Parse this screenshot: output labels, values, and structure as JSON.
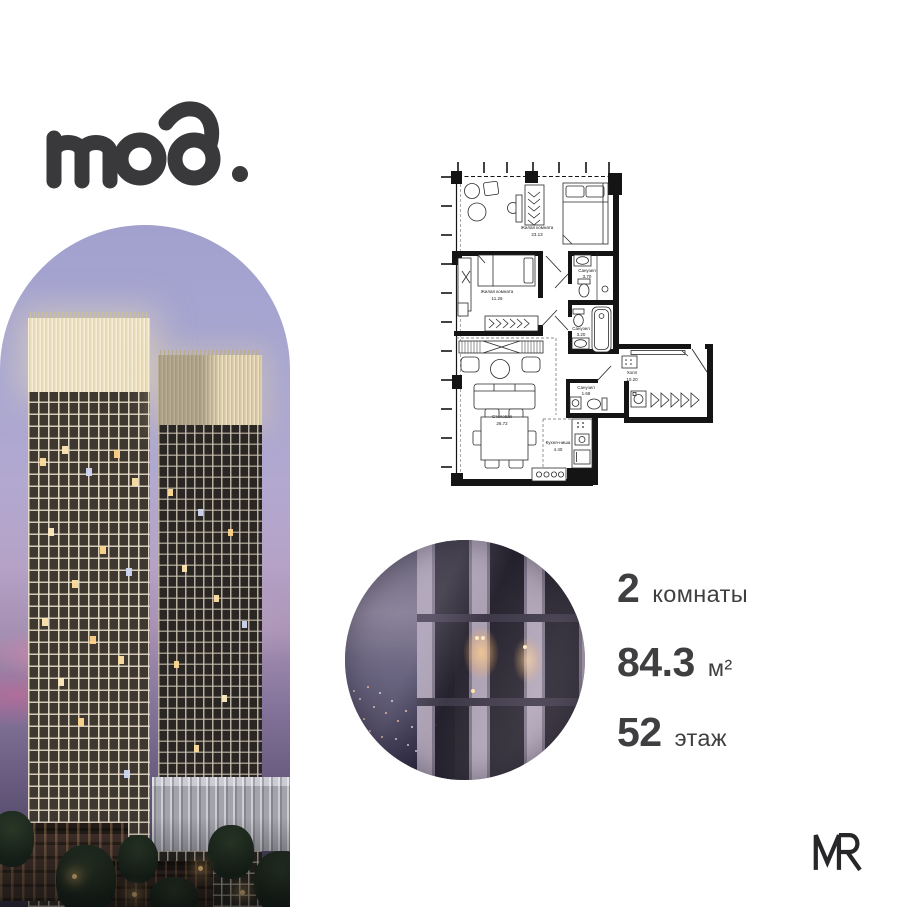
{
  "brand": {
    "logo_text": "mod."
  },
  "floor_plan": {
    "rooms": [
      {
        "name": "Жилая комната",
        "area": "23.13"
      },
      {
        "name": "Жилая комната",
        "area": "11.26"
      },
      {
        "name": "Санузел",
        "area": "3.70"
      },
      {
        "name": "Санузел",
        "area": "3.20"
      },
      {
        "name": "Холл",
        "area": "10.20"
      },
      {
        "name": "Санузел",
        "area": "1.68"
      },
      {
        "name": "Столовая",
        "area": "26.72"
      },
      {
        "name": "Кухня-ниша",
        "area": "4.40"
      }
    ]
  },
  "apartment": {
    "rooms_count": "2",
    "rooms_label": "комнаты",
    "area_value": "84.3",
    "area_unit": "м²",
    "floor_value": "52",
    "floor_label": "этаж"
  },
  "developer": {
    "logo_text": "MR"
  },
  "colors": {
    "brand_ink": "#39393b",
    "stats_text": "#3f3f41",
    "plan_ink": "#141414",
    "sky_lavender": "#a2a1ce"
  }
}
